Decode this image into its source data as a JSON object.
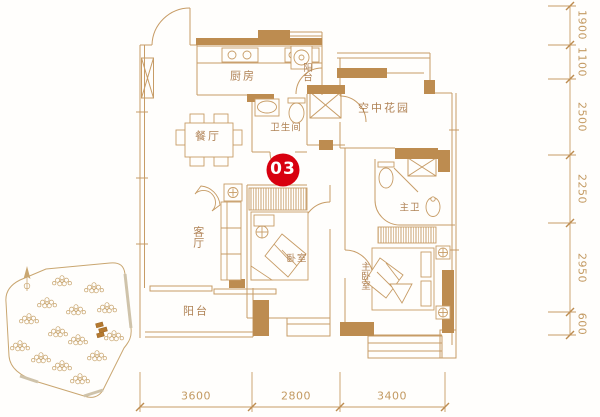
{
  "unit_badge": {
    "label": "03"
  },
  "rooms": {
    "kitchen": "厨房",
    "dining": "餐厅",
    "bathroom": "卫生间",
    "sky_garden": "空中花园",
    "living": "客厅",
    "bedroom": "卧室",
    "master_bathroom": "主卫",
    "master_bedroom": "主卧室",
    "balcony": "阳台",
    "laundry_balcony": "阳台"
  },
  "dimensions": {
    "right": [
      "1900",
      "1100",
      "2500",
      "2250",
      "2950",
      "600"
    ],
    "bottom": [
      "3600",
      "2800",
      "3400"
    ]
  },
  "colors": {
    "wall": "#bd8c50",
    "line": "#c79c66",
    "label_text": "#b08255",
    "dimension_text": "#c39a62",
    "badge_red": "#d8000f",
    "background": "#fffefc"
  }
}
